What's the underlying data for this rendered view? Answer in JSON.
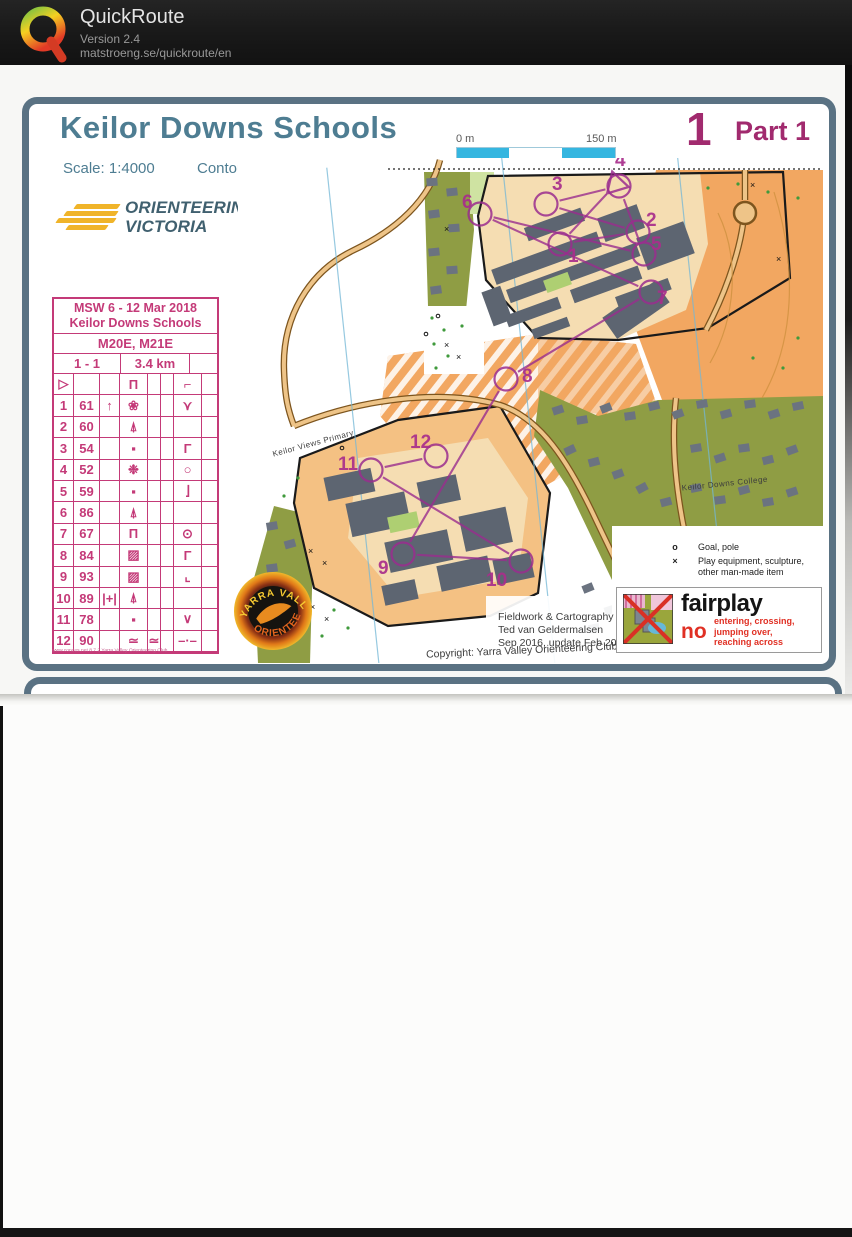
{
  "header": {
    "app": "QuickRoute",
    "version": "Version 2.4",
    "url": "matstroeng.se/quickroute/en"
  },
  "colors": {
    "accent_magenta": "#a12a6e",
    "title_blue": "#4e7d92",
    "card_pink": "#c43a78",
    "map_orange": "#f2a761",
    "map_olive": "#8f9d44",
    "course_purple": "#9a2d8e",
    "scalebar_blue": "#35b6e0"
  },
  "sheet": {
    "title": "Keilor Downs Schools",
    "scale": "Scale: 1:4000",
    "contour": "Contour interval: 2m",
    "course_number": "1",
    "part": "Part 1",
    "scalebar": {
      "start": "0 m",
      "end": "150 m"
    },
    "north": {
      "line1": "Magnetic",
      "line2": "North",
      "letter": "N"
    },
    "ov_logo": {
      "line1": "ORIENTEERING",
      "line2": "VICTORIA"
    },
    "msw": {
      "title": "MSW",
      "year": "2018",
      "org1": "ORIENTEERING",
      "org2": "VICTORIA"
    },
    "note": [
      "This afternoon's",
      "race organised",
      "by:",
      "Victoria",
      "NOL team"
    ],
    "card": {
      "event_line1": "MSW 6 - 12 Mar 2018",
      "event_line2": "Keilor Downs Schools",
      "classes": "M20E, M21E",
      "course": "1 - 1",
      "length": "3.4 km",
      "rows": [
        [
          "▷",
          "",
          "",
          "Π",
          "",
          "",
          "⌐",
          ""
        ],
        [
          "1",
          "61",
          "↑",
          "❀",
          "",
          "",
          "⋎",
          ""
        ],
        [
          "2",
          "60",
          "",
          "⍋",
          "",
          "",
          "",
          ""
        ],
        [
          "3",
          "54",
          "",
          "▪",
          "",
          "",
          "Γ",
          ""
        ],
        [
          "4",
          "52",
          "",
          "❉",
          "",
          "",
          "○",
          ""
        ],
        [
          "5",
          "59",
          "",
          "▪",
          "",
          "",
          "⌋",
          ""
        ],
        [
          "6",
          "86",
          "",
          "⍋",
          "",
          "",
          "",
          ""
        ],
        [
          "7",
          "67",
          "",
          "Π",
          "",
          "",
          "⊙",
          ""
        ],
        [
          "8",
          "84",
          "",
          "▨",
          "",
          "",
          "Γ",
          ""
        ],
        [
          "9",
          "93",
          "",
          "▨",
          "",
          "",
          "⌞",
          ""
        ],
        [
          "10",
          "89",
          "|+|",
          "⍋",
          "",
          "",
          "",
          ""
        ],
        [
          "11",
          "78",
          "",
          "▪",
          "",
          "",
          "∨",
          ""
        ],
        [
          "12",
          "90",
          "",
          "≃",
          "≃",
          "",
          "–·–",
          ""
        ]
      ],
      "footer": "www.condes.net 8.7.2 Yarra Valley Orienteering Club"
    },
    "legend": {
      "sym1": "o",
      "item1": "Goal, pole",
      "sym2": "×",
      "item2a": "Play equipment, sculpture,",
      "item2b": "other man-made item"
    },
    "credits": {
      "line1": "Fieldwork & Cartography",
      "line2": "Ted van Geldermalsen",
      "line3": "Sep 2016, update Feb 2018",
      "copyright": "Copyright: Yarra Valley Orienteering Club 2016"
    },
    "fairplay": {
      "title": "fairplay",
      "no": "no",
      "lines": [
        "entering, crossing,",
        "jumping over,",
        "reaching across"
      ]
    },
    "yvo": {
      "arc_top": "YARRA VALLEY",
      "arc_bottom": "ORIENTEERS"
    },
    "map_labels": {
      "primary": "Keilor Views Primary",
      "college": "Keilor Downs College"
    },
    "course": {
      "color": "#9a2d8e",
      "controls": [
        {
          "t": "start",
          "x": 378,
          "y": 26
        },
        {
          "n": "1",
          "x": 322,
          "y": 86,
          "lx": 330,
          "ly": 104
        },
        {
          "n": "2",
          "x": 400,
          "y": 74,
          "lx": 408,
          "ly": 68
        },
        {
          "n": "3",
          "x": 308,
          "y": 46,
          "lx": 314,
          "ly": 32
        },
        {
          "n": "4",
          "x": 381,
          "y": 28,
          "lx": 377,
          "ly": 8
        },
        {
          "n": "5",
          "x": 406,
          "y": 96,
          "lx": 413,
          "ly": 92
        },
        {
          "n": "6",
          "x": 242,
          "y": 56,
          "lx": 224,
          "ly": 50
        },
        {
          "n": "7",
          "x": 413,
          "y": 134,
          "lx": 419,
          "ly": 146
        },
        {
          "n": "8",
          "x": 268,
          "y": 221,
          "lx": 284,
          "ly": 224
        },
        {
          "n": "9",
          "x": 165,
          "y": 396,
          "lx": 140,
          "ly": 416
        },
        {
          "n": "10",
          "x": 283,
          "y": 403,
          "lx": 248,
          "ly": 428
        },
        {
          "n": "11",
          "x": 133,
          "y": 312,
          "lx": 100,
          "ly": 312
        },
        {
          "n": "12",
          "x": 198,
          "y": 298,
          "lx": 172,
          "ly": 290
        }
      ]
    }
  }
}
